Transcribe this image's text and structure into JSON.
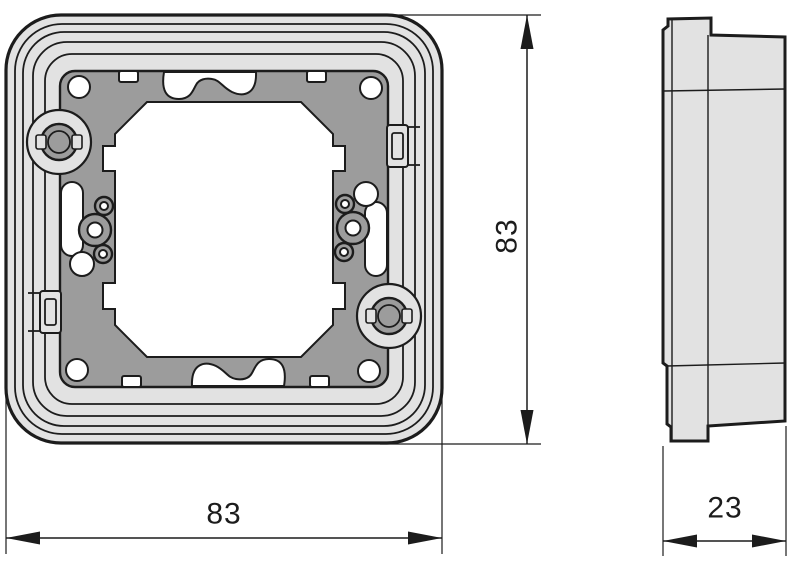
{
  "drawing": {
    "dimensions": {
      "front_width": "83",
      "front_height": "83",
      "side_depth": "23"
    },
    "colors": {
      "outline": "#1c1c1c",
      "frame_fill": "#e2e2e2",
      "plate_fill": "#9c9c9c",
      "cutout_fill": "#ffffff",
      "background": "#ffffff"
    }
  }
}
